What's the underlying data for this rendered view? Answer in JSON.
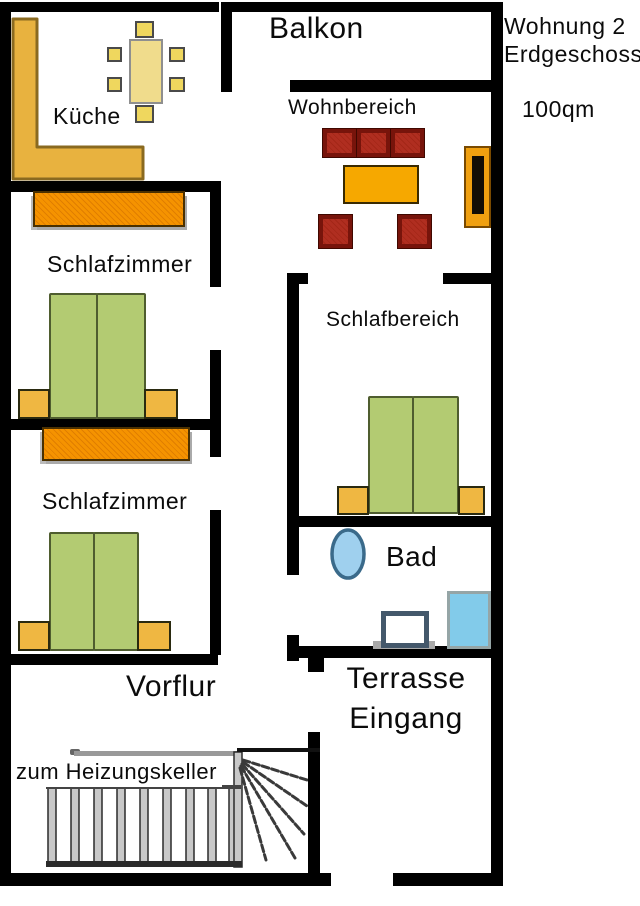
{
  "title": {
    "apartment": "Wohnung 2",
    "floor": "Erdgeschoss",
    "area": "100qm"
  },
  "rooms": {
    "balkon": "Balkon",
    "kueche": "Küche",
    "wohnbereich": "Wohnbereich",
    "schlafzimmer_oben": "Schlafzimmer",
    "schlafzimmer_unten": "Schlafzimmer",
    "schlafbereich": "Schlafbereich",
    "bad": "Bad",
    "vorflur": "Vorflur",
    "terrasse": "Terrasse",
    "eingang": "Eingang"
  },
  "annotations": {
    "stairs": "zum Heizungskeller"
  },
  "colors": {
    "wall": "#000000",
    "kitchen_counter": "#E8B23F",
    "dining_table": "#F0DC8C",
    "chair": "#EFD75E",
    "wardrobe": "#F59300",
    "bed": "#B3CB72",
    "nightstand": "#EFB742",
    "sofa": "#B02E20",
    "coffee_table": "#F6A800",
    "tv_cabinet": "#F0A010",
    "toilet": "#9FD0EE",
    "shower": "#82CBEA",
    "stair_rail": "#999999"
  }
}
